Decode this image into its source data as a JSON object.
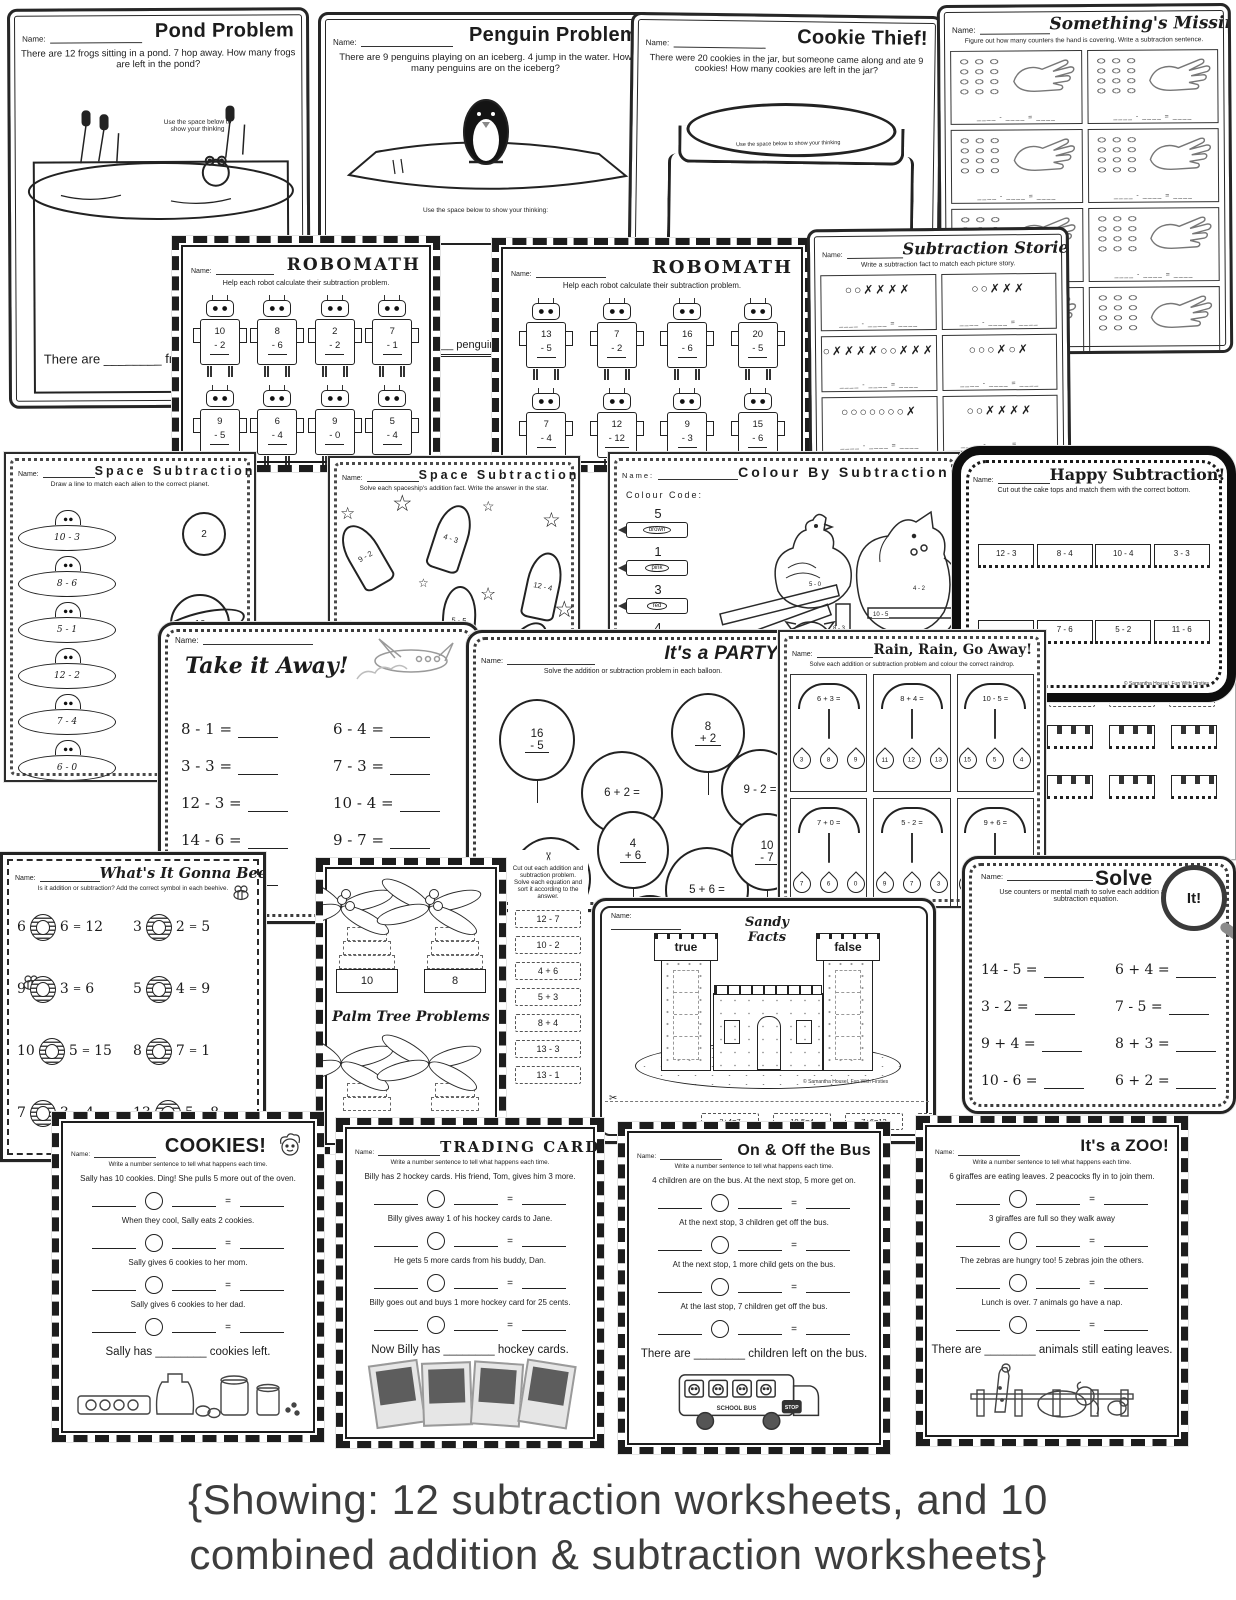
{
  "common": {
    "name_label": "Name:",
    "equals": "=",
    "sentence_instr": "Write a number sentence to tell what happens each time."
  },
  "caption": {
    "line1": "{Showing: 12 subtraction worksheets, and 10",
    "line2": "combined addition & subtraction worksheets}"
  },
  "sheets": {
    "pond": {
      "title": "Pond Problem",
      "prompt": "There are 12 frogs sitting in a pond. 7 hop away. How many frogs are left in the pond?",
      "hint": "Use the space below to show your thinking",
      "answer": "There are ________ frogs"
    },
    "penguin": {
      "title": "Penguin Problem",
      "prompt": "There are 9 penguins playing on an iceberg. 4 jump in the water. How many penguins are on the iceberg?",
      "hint": "Use the space below to show your thinking:",
      "answer_fragment": "__ penguin"
    },
    "cookie": {
      "title": "Cookie Thief!",
      "prompt": "There were 20 cookies in the jar, but someone came along and ate 9 cookies! How many cookies are left in the jar?",
      "hint": "Use the space below to show your thinking",
      "answer": "There are ____ cookies in the jar."
    },
    "missing": {
      "title": "Something's Missing...",
      "instr": "Figure out how many counters the hand is covering. Write a subtraction sentence.",
      "equation": "____ - ____ = ____",
      "boxes": [
        "",
        "",
        "",
        "",
        "",
        "",
        "",
        ""
      ]
    },
    "robomath1": {
      "title": "ROBOMATH",
      "instr": "Help each robot calculate their subtraction problem.",
      "problems": [
        {
          "t": "10",
          "b": "- 2"
        },
        {
          "t": "8",
          "b": "- 6"
        },
        {
          "t": "2",
          "b": "- 2"
        },
        {
          "t": "7",
          "b": "- 1"
        },
        {
          "t": "9",
          "b": "- 5"
        },
        {
          "t": "6",
          "b": "- 4"
        },
        {
          "t": "9",
          "b": "- 0"
        },
        {
          "t": "5",
          "b": "- 4"
        }
      ]
    },
    "robomath2": {
      "title": "ROBOMATH",
      "instr": "Help each robot calculate their subtraction problem.",
      "problems": [
        {
          "t": "13",
          "b": "- 5"
        },
        {
          "t": "7",
          "b": "- 2"
        },
        {
          "t": "16",
          "b": "- 6"
        },
        {
          "t": "20",
          "b": "- 5"
        },
        {
          "t": "7",
          "b": "- 4"
        },
        {
          "t": "12",
          "b": "- 12"
        },
        {
          "t": "9",
          "b": "- 3"
        },
        {
          "t": "15",
          "b": "- 6"
        }
      ]
    },
    "stories": {
      "title": "Subtraction Stories",
      "instr": "Write a subtraction fact to match each picture story.",
      "equation": "____ - ____ = ____",
      "boxes": [
        "○○✗✗✗✗",
        "○○✗✗✗",
        "○✗✗✗✗○○✗✗✗",
        "○○○✗○✗",
        "○○○○○○○✗",
        "○○✗✗✗✗"
      ]
    },
    "spaceMatch": {
      "title": "Space Subtraction",
      "instr": "Draw a line to match each alien to the correct planet.",
      "ufos": [
        "10 - 3",
        "8 - 6",
        "5 - 1",
        "12 - 2",
        "7 - 4",
        "6 - 0"
      ],
      "planets": [
        "2",
        "10",
        "4"
      ]
    },
    "spaceRockets": {
      "title": "Space Subtraction",
      "instr": "Solve each spaceship's addition fact. Write the answer in the star.",
      "rockets": [
        "9 - 2",
        "4 - 3",
        "12 - 4",
        "5 - 5",
        "6 - 1"
      ]
    },
    "colour": {
      "title": "Colour By Subtraction Fact",
      "code_label": "Colour Code:",
      "codes": [
        {
          "num": "5",
          "color": "brown"
        },
        {
          "num": "1",
          "color": "pink"
        },
        {
          "num": "3",
          "color": "red"
        },
        {
          "num": "4",
          "color": ""
        }
      ],
      "facts": [
        "5 - 0",
        "4 - 2",
        "10 - 5",
        "8 - 3",
        "8 - 7",
        "7 - 2",
        "11 - 5",
        "12 - 1"
      ]
    },
    "happy": {
      "title": "Happy Subtraction!",
      "instr": "Cut out the cake tops and match them with the correct bottom.",
      "cakes": [
        "12 - 3",
        "8 - 4",
        "10 - 4",
        "3 - 3",
        "",
        "7 - 6",
        "5 - 2",
        "11 - 6"
      ],
      "credit": "© Samantha Housel, Fun With Firsties"
    },
    "cakeTops": {
      "cards": [
        "1",
        "13",
        ""
      ]
    },
    "takeAway": {
      "title": "Take it Away!",
      "left": [
        "8 - 1 =",
        "3 - 3 =",
        "12 - 3 =",
        "14 - 6 =",
        "5 - 0 ="
      ],
      "right": [
        "6 - 4 =",
        "7 - 3 =",
        "10 - 4 =",
        "9 - 7 =",
        "11 - 3 ="
      ],
      "extra": "15"
    },
    "party": {
      "title": "It's a PARTY!",
      "instr": "Solve the addition or subtraction problem in each balloon.",
      "balloons": [
        {
          "l1": "16",
          "l2": "- 5"
        },
        {
          "l1": "6 + 2 =",
          "l2": ""
        },
        {
          "l1": "8",
          "l2": "+ 2"
        },
        {
          "l1": "9 - 2 =",
          "l2": ""
        },
        {
          "l1": "8 - 3 =",
          "l2": ""
        },
        {
          "l1": "4",
          "l2": "+ 6"
        },
        {
          "l1": "5 + 6 =",
          "l2": ""
        },
        {
          "l1": "10",
          "l2": "- 7"
        },
        {
          "l1": "9",
          "l2": "- 6"
        }
      ]
    },
    "rain": {
      "title": "Rain, Rain, Go Away!",
      "instr": "Solve each addition or subtraction problem and colour the correct raindrop.",
      "cells": [
        {
          "eq": "6 + 3 =",
          "d1": "3",
          "d2": "8",
          "d3": "9"
        },
        {
          "eq": "8 + 4 =",
          "d1": "11",
          "d2": "12",
          "d3": "13"
        },
        {
          "eq": "10 - 5 =",
          "d1": "15",
          "d2": "5",
          "d3": "4"
        },
        {
          "eq": "7 + 0 =",
          "d1": "7",
          "d2": "6",
          "d3": "0"
        },
        {
          "eq": "5 - 2 =",
          "d1": "9",
          "d2": "7",
          "d3": "3"
        },
        {
          "eq": "9 + 6 =",
          "d1": "12",
          "d2": "15",
          "d3": "3"
        },
        {
          "eq": "12 - 2 =",
          "d1": "",
          "d2": "",
          "d3": ""
        },
        {
          "eq": "20 - 3 =",
          "d1": "",
          "d2": "",
          "d3": ""
        }
      ]
    },
    "bee": {
      "title": "What's It Gonna Bee?",
      "instr": "Is it addition or subtraction? Add the correct symbol in each beehive.",
      "problems": [
        {
          "a": "6",
          "b": "6",
          "c": "12"
        },
        {
          "a": "3",
          "b": "2",
          "c": "5"
        },
        {
          "a": "9",
          "b": "3",
          "c": "6"
        },
        {
          "a": "5",
          "b": "4",
          "c": "9"
        },
        {
          "a": "10",
          "b": "5",
          "c": "15"
        },
        {
          "a": "8",
          "b": "7",
          "c": "1"
        },
        {
          "a": "7",
          "b": "3",
          "c": "4"
        },
        {
          "a": "13",
          "b": "5",
          "c": "8"
        }
      ]
    },
    "palm": {
      "title": "Palm Tree Problems",
      "trunks": [
        "10",
        "8"
      ]
    },
    "sortStrip": {
      "instr": "Cut out each addition and subtraction problem. Solve each equation and sort it according to the answer.",
      "cards": [
        "12 - 7",
        "10 - 2",
        "4 + 6",
        "5 + 3",
        "8 + 4",
        "13 - 3",
        "13 - 1"
      ]
    },
    "castle": {
      "title1": "Sandy",
      "title2": "Facts",
      "true_label": "true",
      "false_label": "false",
      "credit": "© Samantha Housel, Fun With Firsties",
      "cards": [
        "3+4=7",
        "10-5=4",
        "7+6=12",
        "6-2=3"
      ]
    },
    "solve": {
      "title": "Solve",
      "mag_label": "It!",
      "instr": "Use counters or mental math to solve each addition and subtraction equation.",
      "left": [
        "14 - 5 =",
        "3 - 2 =",
        "9 + 4 =",
        "10 - 6 =",
        "8 - 3 ="
      ],
      "right": [
        "6 + 4 =",
        "7 - 5 =",
        "8 + 3 =",
        "6 + 2 =",
        "11 - 5 ="
      ]
    },
    "cookies": {
      "title": "COOKIES!",
      "lines": [
        "Sally has 10 cookies. Ding! She pulls 5 more out of the oven.",
        "When they cool, Sally eats 2 cookies.",
        "Sally gives 6 cookies to her mom.",
        "Sally gives 6 cookies to her dad."
      ],
      "answer": "Sally has ________ cookies left."
    },
    "trading": {
      "title": "TRADING CARDS",
      "lines": [
        "Billy has 2 hockey cards. His friend, Tom, gives him 3 more.",
        "Billy gives away 1 of his hockey cards to Jane.",
        "He gets 5 more cards from his buddy, Dan.",
        "Billy goes out and buys 1 more hockey card for 25 cents."
      ],
      "answer": "Now Billy has ________ hockey cards."
    },
    "bus": {
      "title": "On & Off the Bus",
      "lines": [
        "4 children are on the bus. At the next stop, 5 more get on.",
        "At the next stop, 3 children get off the bus.",
        "At the next stop, 1 more child gets on the bus.",
        "At the last stop, 7 children get off the bus."
      ],
      "answer": "There are ________ children left on the bus.",
      "stop_label": "STOP",
      "school_label": "SCHOOL BUS"
    },
    "zoo": {
      "title": "It's a ZOO!",
      "lines": [
        "6 giraffes are eating leaves. 2 peacocks fly in to join them.",
        "3 giraffes are full so they walk away",
        "The zebras are hungry too! 5 zebras join the others.",
        "Lunch is over. 7 animals go have a nap."
      ],
      "answer": "There are ________ animals still eating leaves."
    }
  }
}
